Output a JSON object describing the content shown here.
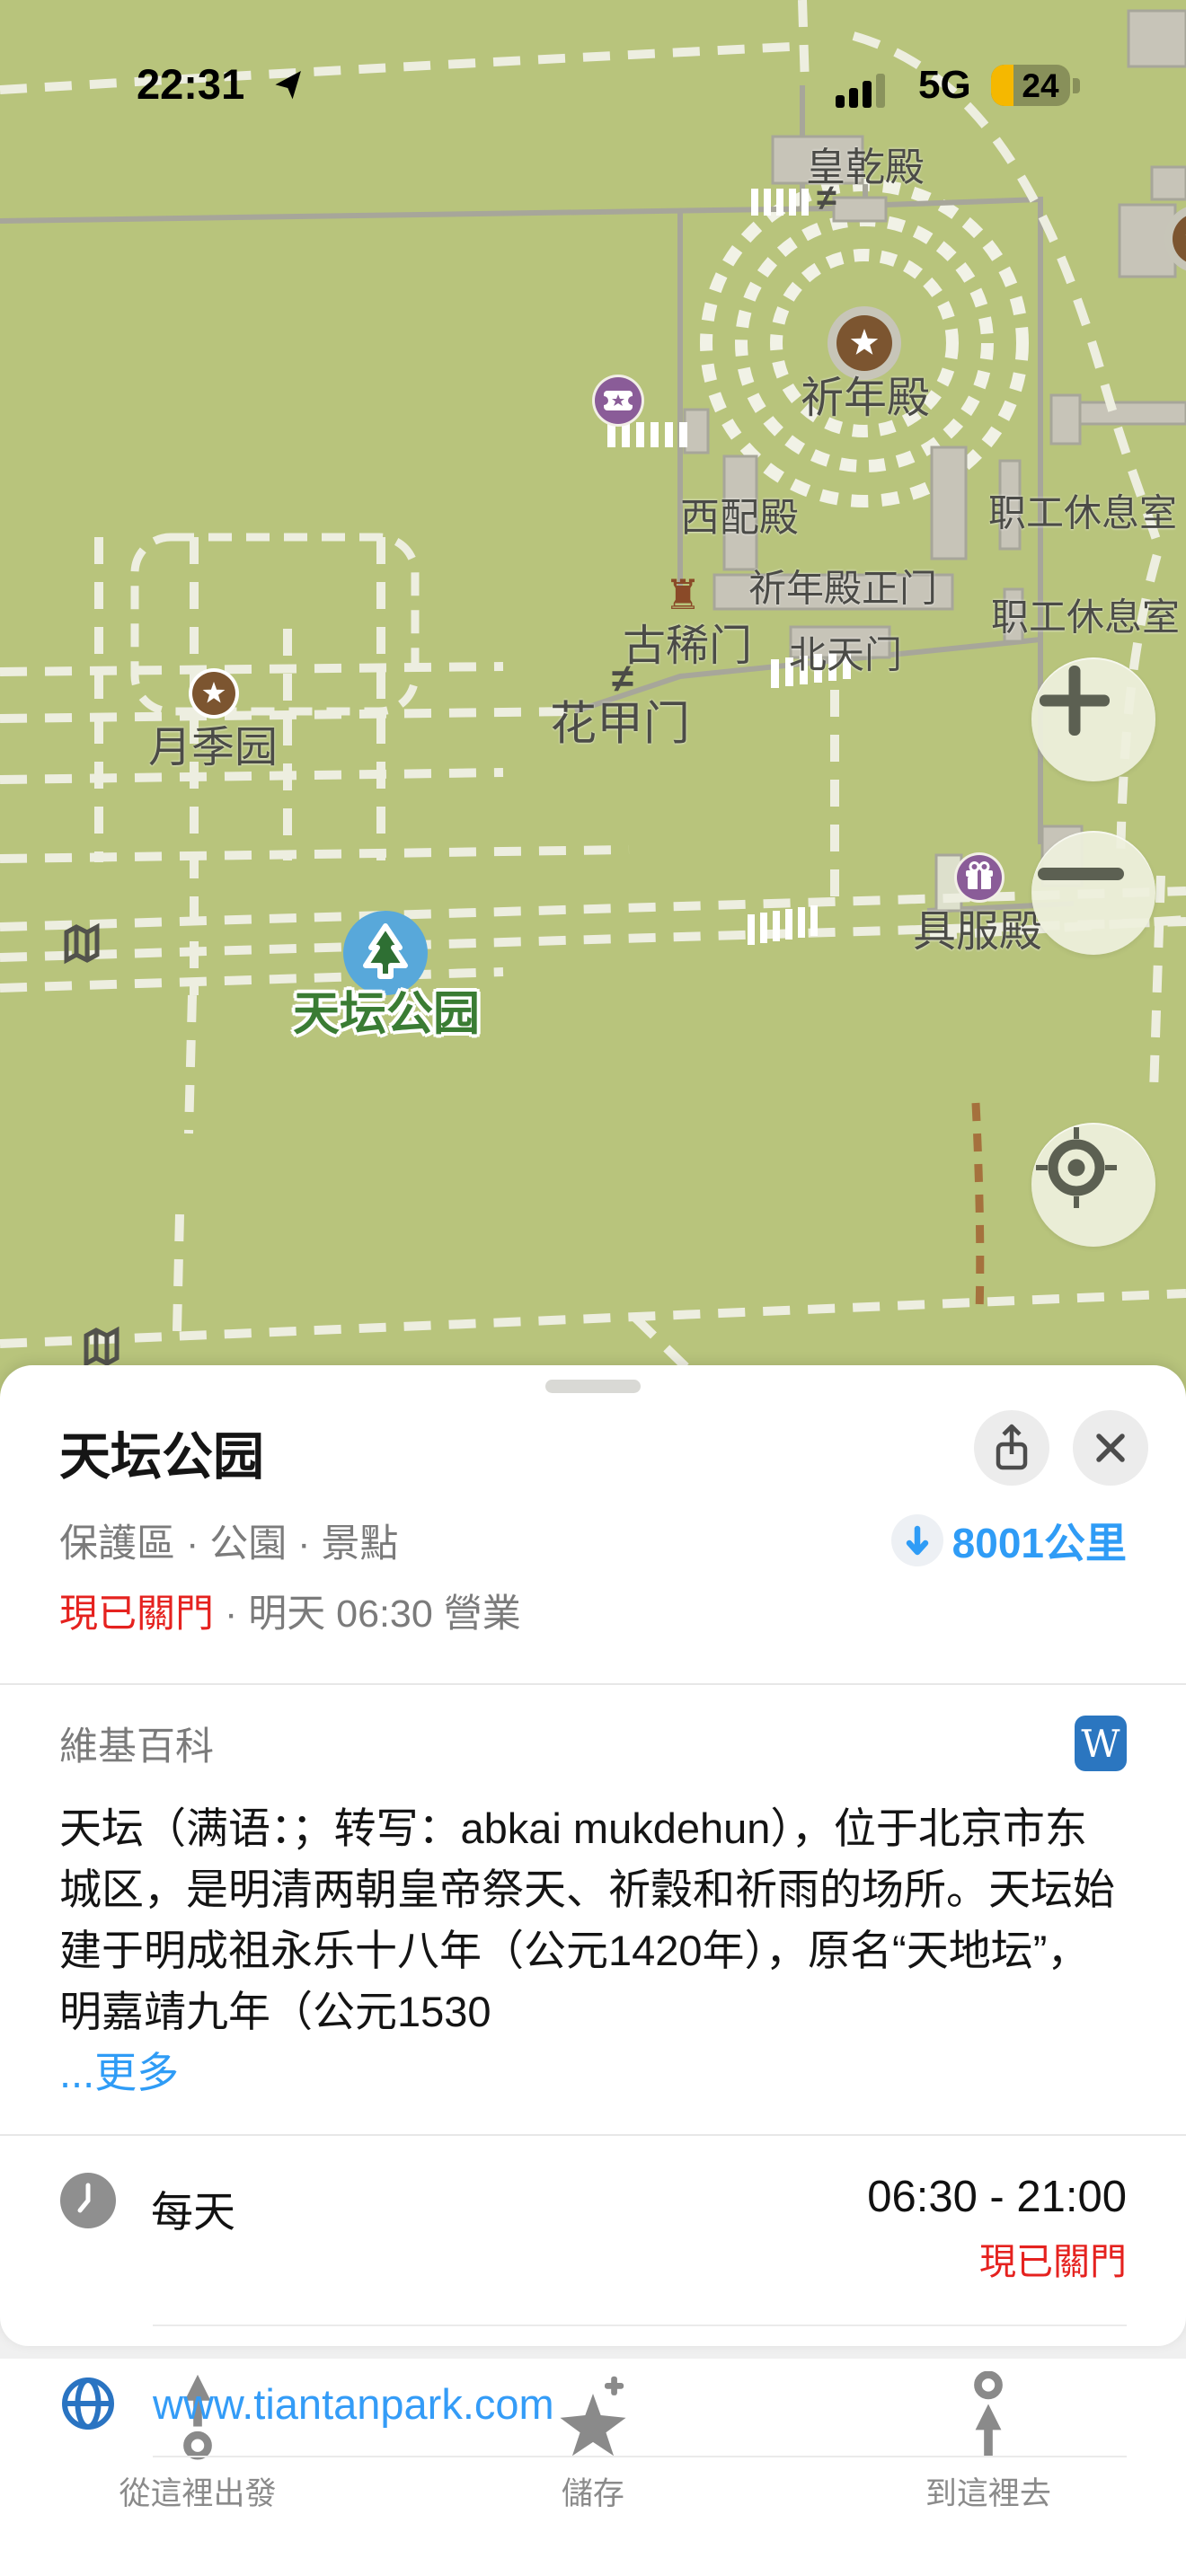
{
  "status_bar": {
    "time": "22:31",
    "network": "5G",
    "battery_percent": "24"
  },
  "map": {
    "gate_symbol": "≠",
    "castle_symbol": "♜",
    "labels": [
      {
        "text": "皇乾殿"
      },
      {
        "text": "祈年殿"
      },
      {
        "text": "西配殿"
      },
      {
        "text": "职工休息室"
      },
      {
        "text": "祈年殿正门"
      },
      {
        "text": "职工休息室"
      },
      {
        "text": "北天门"
      },
      {
        "text": "古稀门"
      },
      {
        "text": "花甲门"
      },
      {
        "text": "月季园"
      },
      {
        "text": "具服殿"
      },
      {
        "text": "天坛公园"
      }
    ]
  },
  "map_controls": {
    "zoom_in": "+",
    "zoom_out": "−"
  },
  "place_card": {
    "title": "天坛公园",
    "category": "保護區 · 公園 · 景點",
    "distance": "8001公里",
    "status_closed": "現已關門",
    "status_rest": " · 明天 06:30 營業",
    "wiki_header": "維基百科",
    "wiki_badge": "W",
    "wiki_text": "天坛（满语：；转写：abkai mukdehun），位于北京市东城区，是明清两朝皇帝祭天、祈穀和祈雨的场所。天坛始建于明成祖永乐十八年（公元1420年），原名“天地坛”，明嘉靖九年（公元1530",
    "wiki_more": "...更多",
    "hours_label": "每天",
    "hours_time": "06:30 - 21:00",
    "hours_status": "現已關門",
    "website": "www.tiantanpark.com"
  },
  "toolbar": {
    "from_here": "從這裡出發",
    "save": "儲存",
    "to_here": "到這裡去"
  },
  "colors": {
    "map_green": "#b8c47c",
    "path_white": "#edeee0",
    "accent_blue": "#2f9cf6",
    "wikipedia_blue": "#2b76c0",
    "closed_red": "#e5221f",
    "marker_brown": "#7c5530",
    "poi_purple": "#8a5c98",
    "park_label_green": "#3a7c33",
    "battery_yellow": "#f5b800"
  }
}
